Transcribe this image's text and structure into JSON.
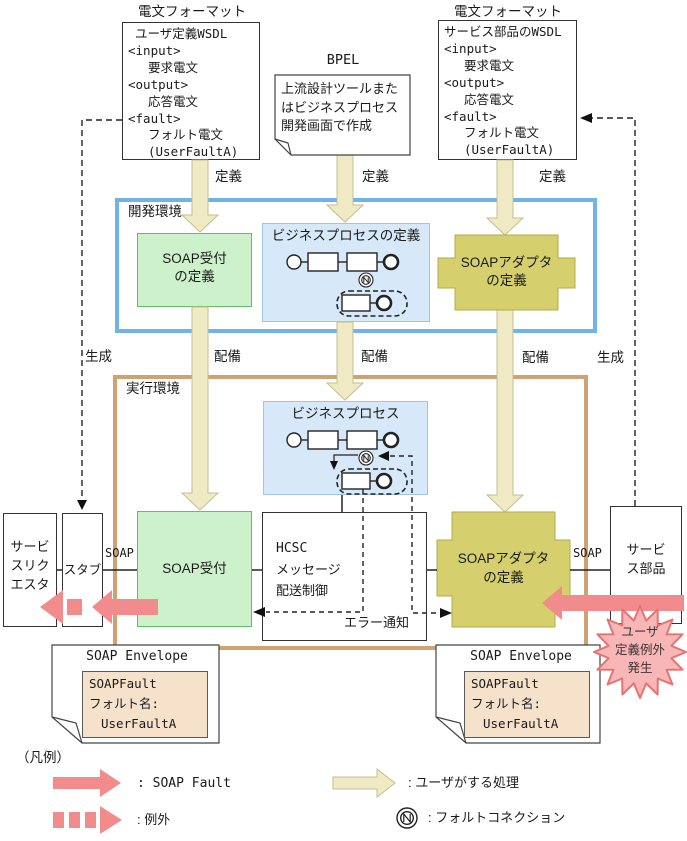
{
  "wsdl_left": {
    "tag": "電文フォーマット",
    "lines": [
      "ユーザ定義WSDL",
      "<input>",
      "要求電文",
      "<output>",
      "応答電文",
      "<fault>",
      "フォルト電文",
      "(UserFaultA)"
    ]
  },
  "wsdl_right": {
    "tag": "電文フォーマット",
    "lines": [
      "サービス部品のWSDL",
      "<input>",
      "要求電文",
      "<output>",
      "応答電文",
      "<fault>",
      "フォルト電文",
      "(UserFaultA)"
    ]
  },
  "bpel": {
    "title": "BPEL",
    "note_lines": [
      "上流設計ツールまた",
      "はビジネスプロセス",
      "開発画面で作成"
    ]
  },
  "edge_labels": {
    "define": "定義",
    "deploy": "配備",
    "generate": "生成",
    "soap": "SOAP"
  },
  "dev_env": {
    "label": "開発環境",
    "reception_def_lines": [
      "SOAP受付",
      "の定義"
    ],
    "bp_def_title": "ビジネスプロセスの定義",
    "adapter_def_lines": [
      "SOAPアダプタ",
      "の定義"
    ]
  },
  "runtime_env": {
    "label": "実行環境",
    "bp_title": "ビジネスプロセス",
    "reception_label": "SOAP受付",
    "hcsc_lines": [
      "HCSC",
      "メッセージ",
      "配送制御"
    ],
    "error_label": "エラー通知",
    "adapter_lines": [
      "SOAPアダプタ",
      "の定義"
    ]
  },
  "side_boxes": {
    "requester_lines": [
      "サービ",
      "スリク",
      "エスタ"
    ],
    "stub": "スタブ",
    "component_lines": [
      "サービ",
      "ス部品"
    ]
  },
  "starburst": {
    "lines": [
      "ユーザ",
      "定義例外",
      "発生"
    ]
  },
  "envelope_left": {
    "title": "SOAP Envelope",
    "fault_lines": [
      "SOAPFault",
      "フォルト名:",
      "UserFaultA"
    ]
  },
  "envelope_right": {
    "title": "SOAP Envelope",
    "fault_lines": [
      "SOAPFault",
      "フォルト名:",
      "UserFaultA"
    ]
  },
  "legend": {
    "title": "（凡例）",
    "soap_fault": ": SOAP Fault",
    "exception": ": 例外",
    "user_action": ": ユーザがする処理",
    "fault_connection": ": フォルトコネクション"
  },
  "colors": {
    "user_action_arrow": "#EFEAC4",
    "soap_fault_arrow": "#F28C8C",
    "dev_env_border": "#6FB3E8",
    "runtime_env_border": "#D1A170",
    "reception_fill": "#CDF2CB",
    "adapter_fill": "#D5CF6D",
    "process_fill": "#D7E9F8",
    "envelope_fill": "#F6E2CB",
    "starburst_fill": "#F8B6B6"
  }
}
